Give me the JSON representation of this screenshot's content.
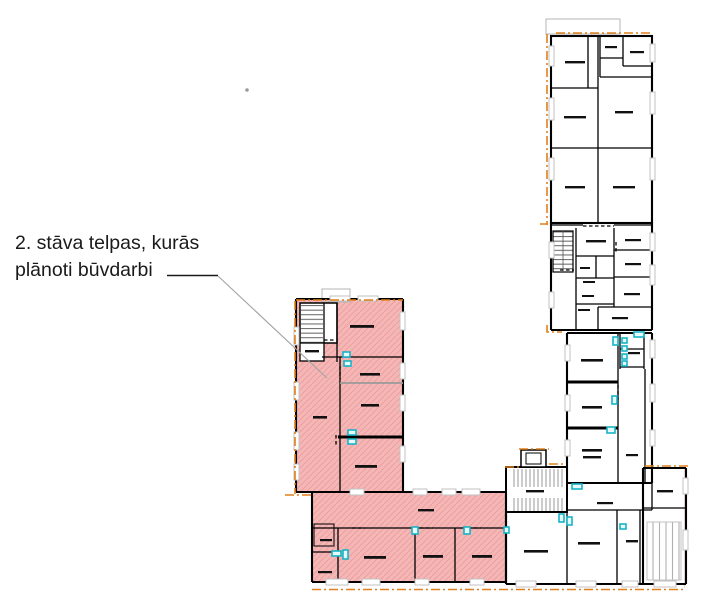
{
  "annotation": {
    "line1": "2. stāva telpas, kurās",
    "line2": "plānoti būvdarbi"
  },
  "colors": {
    "background": "#ffffff",
    "wall": "#000000",
    "highlight_fill": "#f5b6b6",
    "highlight_hatch": "#eb9e9e",
    "outline_orange": "#e0801c",
    "window_gray": "#c2c2c2",
    "detail_gray": "#8f8f8f",
    "fixture_cyan": "#17b4c6",
    "leader_gray": "#a3a3a3",
    "text_black": "#1a1a1a",
    "ref_pink": "#f3d7d7"
  }
}
